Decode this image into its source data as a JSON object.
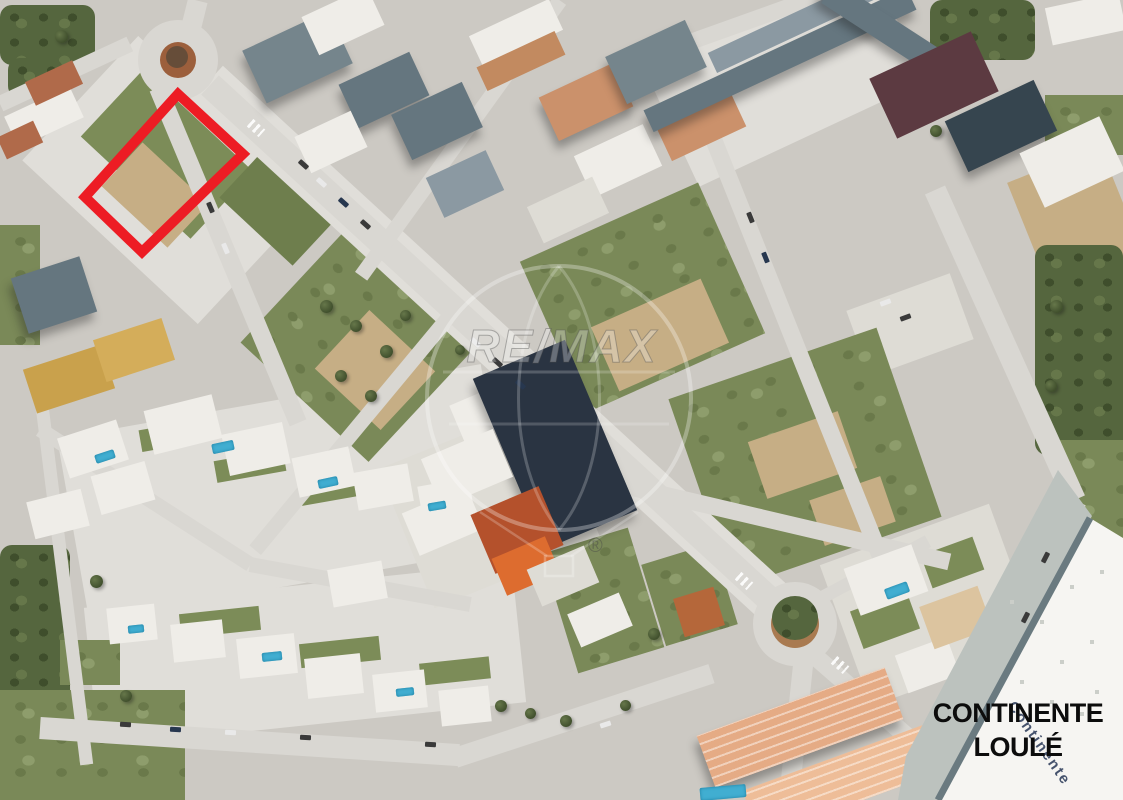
{
  "window": {
    "kind": "real-estate-aerial-photo",
    "width": 1123,
    "height": 800
  },
  "map": {
    "style": "satellite",
    "location_label": {
      "line1": "CONTINENTE",
      "line2": "LOULÉ",
      "color": "#0c0c0c"
    },
    "highlight": {
      "name": "land-plot-boundary",
      "shape": "polygon",
      "points": "178,94 243,154 142,252 85,197",
      "stroke": "#ED1C24",
      "stroke_width": 10
    },
    "watermark": {
      "brand": "RE/MAX",
      "text": "RE/MAX",
      "registered": "®"
    },
    "roof_sign": {
      "text": "Continente"
    }
  }
}
